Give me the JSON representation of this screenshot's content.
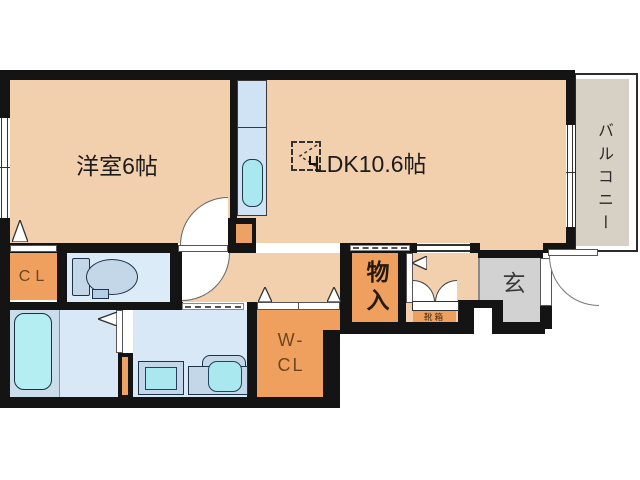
{
  "rooms": {
    "bedroom": "洋室6帖",
    "ldk": "LDK10.6帖",
    "balcony": "バルコニー",
    "closet": "CL",
    "walk_in_closet_line1": "W-",
    "walk_in_closet_line2": "CL",
    "storage": "物入",
    "entrance": "玄",
    "shoe_box": "靴箱"
  },
  "colors": {
    "wall": "#141414",
    "room_peach": "#f2cfad",
    "accent_orange": "#efa05f",
    "water_blue": "#d9e8f6",
    "kitchen_blue": "#cfe3f5",
    "fixture_cyan": "#a9e8ef",
    "entrance_gray": "#d2d2d2",
    "balcony_beige": "#d7d0c5",
    "label_brown": "#6e4620"
  }
}
